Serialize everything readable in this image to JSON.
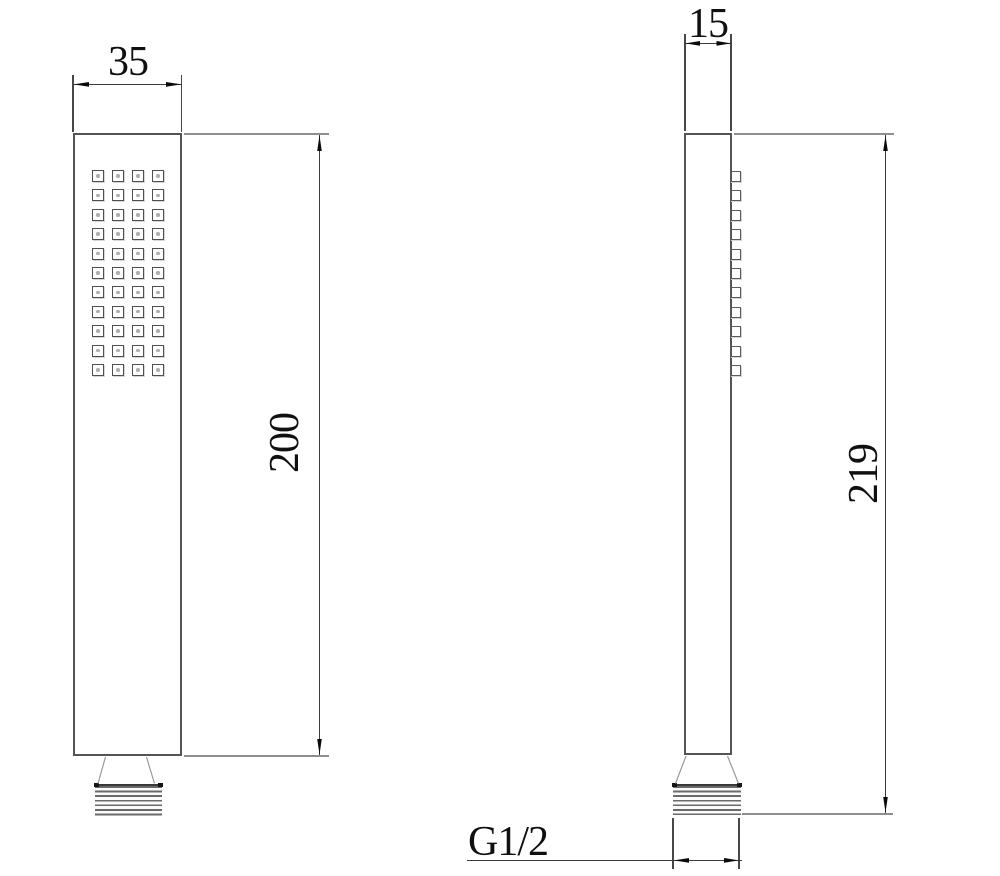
{
  "drawing": {
    "front_view": {
      "width_dim": "35",
      "height_dim": "200",
      "spray_grid": {
        "columns": 4,
        "rows": 11
      }
    },
    "side_view": {
      "depth_dim": "15",
      "height_dim": "219",
      "thread_spec": "G1/2",
      "nozzle_count": 11
    }
  },
  "colors": {
    "outline": "#545454",
    "extension_line": "#8e8e8e",
    "dimension_line": "#3c3c3c",
    "arrow": "#0a0a0a",
    "text": "#101010",
    "hole_dot": "#aeaeae",
    "background": "#ffffff"
  }
}
